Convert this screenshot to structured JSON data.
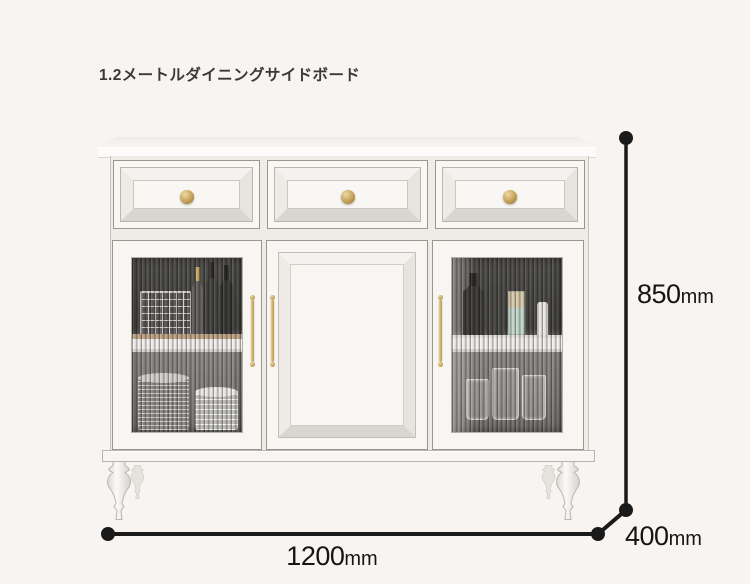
{
  "product": {
    "title": "1.2メートルダイニングサイドボード"
  },
  "dimensions": {
    "height": {
      "value": "850",
      "unit": "mm"
    },
    "width": {
      "value": "1200",
      "unit": "mm"
    },
    "depth": {
      "value": "400",
      "unit": "mm"
    }
  },
  "style": {
    "background": "#f8f4f1",
    "dimension_line_color": "#1a1a1a",
    "cabinet_color": "#f8f6f3",
    "brass_hardware_color": "#c6a15b",
    "glass_interior_color": "#454442"
  }
}
